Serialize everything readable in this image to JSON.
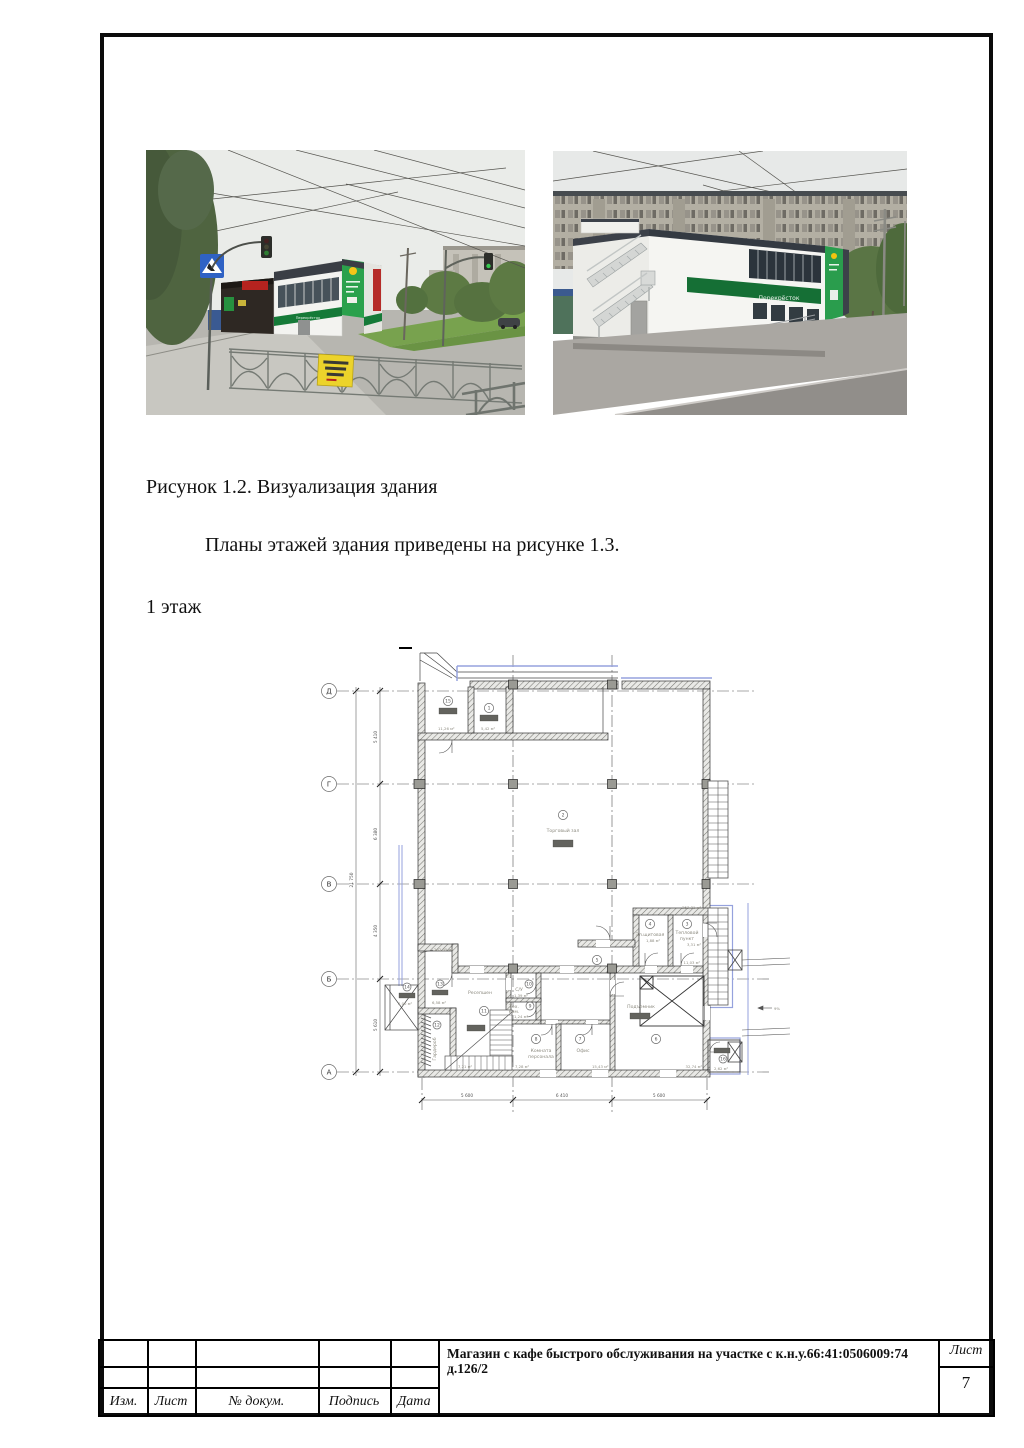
{
  "texts": {
    "figure_caption": "Рисунок 1.2. Визуализация здания",
    "paragraph": "Планы этажей  здания приведены на рисунке 1.3.",
    "floor_label": "1 этаж"
  },
  "photos": {
    "left": {
      "sign_text": "Перекрёсток"
    },
    "right": {
      "banner_text": "Перекрёсток"
    }
  },
  "floor_plan": {
    "axis_labels": [
      "Д",
      "Г",
      "В",
      "Б",
      "А"
    ],
    "rooms": [
      {
        "num": "15",
        "area": "11,26 м²"
      },
      {
        "num": "1",
        "area": "5,42 м²"
      },
      {
        "num": "2",
        "name": "Торговый зал",
        "area": "253,31 м²"
      },
      {
        "num": "3",
        "name_l1": "Тепловой",
        "name_l2": "пункт",
        "area": "3,31 м²"
      },
      {
        "num": "4",
        "name": "Эл.щитовая",
        "area": "1,88 м²"
      },
      {
        "num": "5",
        "area": "11,03 м²"
      },
      {
        "num": "6",
        "name": "Подъемник",
        "area": "32,74 м²"
      },
      {
        "num": "7",
        "name": "Офис",
        "area": "15,43 м²"
      },
      {
        "num": "8",
        "name_l1": "Комната",
        "name_l2": "персонала",
        "area": "7,28 м²"
      },
      {
        "num": "9",
        "name_l1": "Тех.",
        "name_l2": "ком.",
        "area": "1,24 м²"
      },
      {
        "num": "10",
        "name": "С/У",
        "area": "1,39 м²"
      },
      {
        "num": "11",
        "name": "Ресепшен"
      },
      {
        "num": "12",
        "name": "Гардероб",
        "area": "7,21 м²"
      },
      {
        "num": "13",
        "area": "6,58 м²"
      },
      {
        "num": "14",
        "area": "2,00 м²"
      },
      {
        "num": "16",
        "area": "2,62 м²"
      }
    ],
    "dims_bottom": [
      "5 600",
      "6 410",
      "5 600"
    ],
    "dims_left": [
      "5 410",
      "6 380",
      "4 350",
      "5 610"
    ],
    "dim_total": "21 750",
    "annotations": {
      "zone_area": "262,35 м²",
      "slope": "9%"
    }
  },
  "title_block": {
    "columns": [
      "Изм.",
      "Лист",
      "№ докум.",
      "Подпись",
      "Дата"
    ],
    "project_title": "Магазин с кафе быстрого обслуживания на участке с к.н.у.66:41:0506009:74 д.126/2",
    "sheet_label": "Лист",
    "sheet_number": "7"
  }
}
